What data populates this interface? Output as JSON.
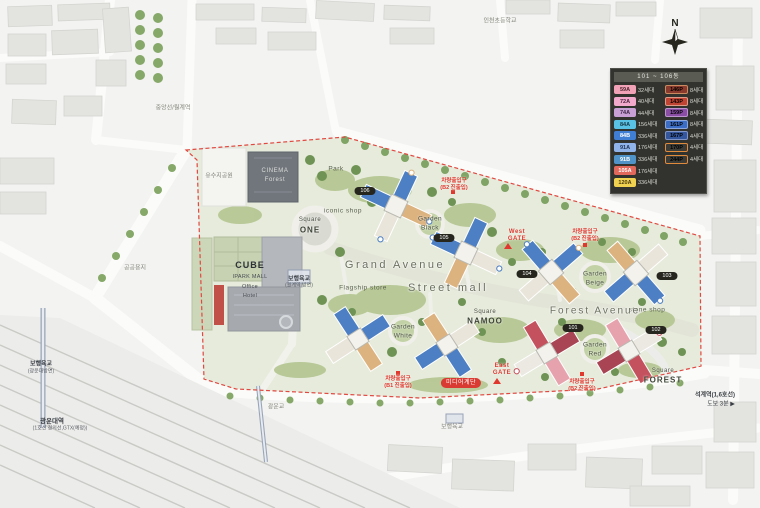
{
  "legend": {
    "title": "101 ~ 106동",
    "rows": [
      {
        "lb": "59A",
        "lc": "#f2a2b6",
        "lt": "#4a2430",
        "lv": "32세대",
        "rb": "146P",
        "rc": "#8a3a2c",
        "rbd": "#c98a60",
        "rv": "8세대"
      },
      {
        "lb": "72A",
        "lc": "#f2a9cb",
        "lt": "#4a2440",
        "lv": "40세대",
        "rb": "143P",
        "rc": "#bf4434",
        "rbd": "#dd9a86",
        "rv": "8세대"
      },
      {
        "lb": "74A",
        "lc": "#c9a0d6",
        "lt": "#3a2644",
        "lv": "44세대",
        "rb": "159P",
        "rc": "#8a4fa5",
        "rbd": "#bd93cf",
        "rv": "8세대"
      },
      {
        "lb": "84A",
        "lc": "#59c2e4",
        "lt": "#143642",
        "lv": "156세대",
        "rb": "161P",
        "rc": "#3b6dc4",
        "rbd": "#8aa6dd",
        "rv": "8세대"
      },
      {
        "lb": "84B",
        "lc": "#3f7ed2",
        "lt": "#ffffff",
        "lv": "336세대",
        "rb": "167P",
        "rc": "#33569c",
        "rbd": "#8094c7",
        "rv": "4세대"
      },
      {
        "lb": "91A",
        "lc": "#90b3ea",
        "lt": "#1d3050",
        "lv": "176세대",
        "rb": "170P",
        "rc": "#3b3b38",
        "rbd": "#e08a3c",
        "rv": "4세대"
      },
      {
        "lb": "91B",
        "lc": "#4f93c9",
        "lt": "#ffffff",
        "lv": "336세대",
        "rb": "244P",
        "rc": "#3b3b38",
        "rbd": "#e08a3c",
        "rv": "4세대"
      },
      {
        "lb": "105A",
        "lc": "#e2685c",
        "lt": "#ffffff",
        "lv": "176세대",
        "rb": "",
        "rv": ""
      },
      {
        "lb": "120A",
        "lc": "#f0d150",
        "lt": "#4a3c10",
        "lv": "336세대",
        "rb": "",
        "rv": ""
      }
    ]
  },
  "compass": {
    "label": "N"
  },
  "surroundings": {
    "school": "인천초등학교",
    "station_nw": "중앙선/월계역",
    "public_lot": "공공용지",
    "reservoir": "유수지공원",
    "bridge_west_l1": "보행육교",
    "bridge_west_l2": "(광운대방면)",
    "gwangwoon_l1": "광운대역",
    "gwangwoon_l2": "(1호선 경의선,GTX(예정))",
    "bridge_small": "광운교",
    "bridge_center_l1": "보행육교",
    "bridge_center_l2": "(월계역 방면)",
    "bridge_south": "보행육교",
    "seokgye_l1": "석계역(1,6호선)",
    "seokgye_l2": "도보 3분 ▶"
  },
  "site": {
    "avenues": {
      "grand": "Grand Avenue",
      "street": "Street mall",
      "forest": "Forest Avenue"
    },
    "squares": {
      "one_l1": "Square",
      "one_l2": "ONE",
      "namoo_l1": "Square",
      "namoo_l2": "NAMOO",
      "forest_l1": "Square",
      "forest_l2": "FOREST"
    },
    "gardens": {
      "black_l1": "Garden",
      "black_l2": "Black",
      "white_l1": "Garden",
      "white_l2": "White",
      "beige_l1": "Garden",
      "beige_l2": "Beige",
      "red_l1": "Garden",
      "red_l2": "Red"
    },
    "facilities": {
      "cinema_l1": "CINEMA",
      "cinema_l2": "Forest",
      "cube": "CUBE",
      "ipark": "IPARK MALL",
      "office": "Office",
      "hotel": "Hotel",
      "park": "Park",
      "iconic_shop": "iconic shop",
      "stone_shop": "stone shop",
      "flagship": "Flagship store"
    },
    "buildings": [
      "101",
      "102",
      "103",
      "104",
      "105",
      "106"
    ],
    "gates": {
      "west_l1": "West",
      "west_l2": "GATE",
      "east_l1": "East",
      "east_l2": "GATE"
    },
    "notes": {
      "car1_l1": "차량출입구",
      "car1_l2": "(B2 진출입)",
      "car2_l1": "차량출입구",
      "car2_l2": "(B2 진출입)",
      "car3_l1": "차량출입구",
      "car3_l2": "(B1 진출입)",
      "car4_l1": "차량출입구",
      "car4_l2": "(B2 진출입)",
      "media": "미디어계단"
    }
  },
  "colors": {
    "boundary": "#e04840",
    "accent_red": "#d93a32",
    "site_green": "#e6ebdb"
  }
}
